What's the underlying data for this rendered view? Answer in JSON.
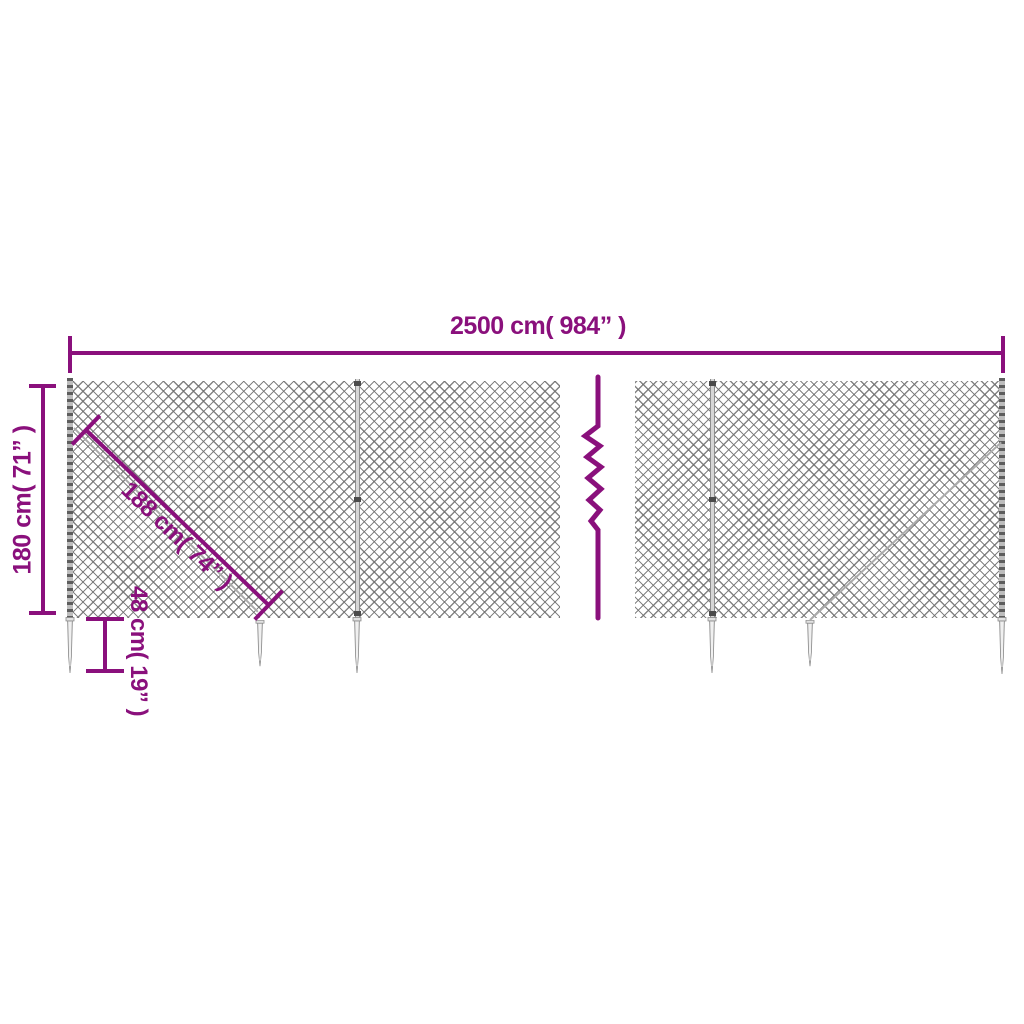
{
  "colors": {
    "accent": "#8A107C",
    "mesh_line": "#8f8f8f",
    "metal_light": "#d9d9d9",
    "metal_dark": "#5d5d5d"
  },
  "dimensions": {
    "total_width_label": "2500 cm( 984” )",
    "height_label": "180 cm( 71” )",
    "diagonal_label": "188 cm( 74” )",
    "spike_depth_label": "48 cm( 19” )"
  }
}
